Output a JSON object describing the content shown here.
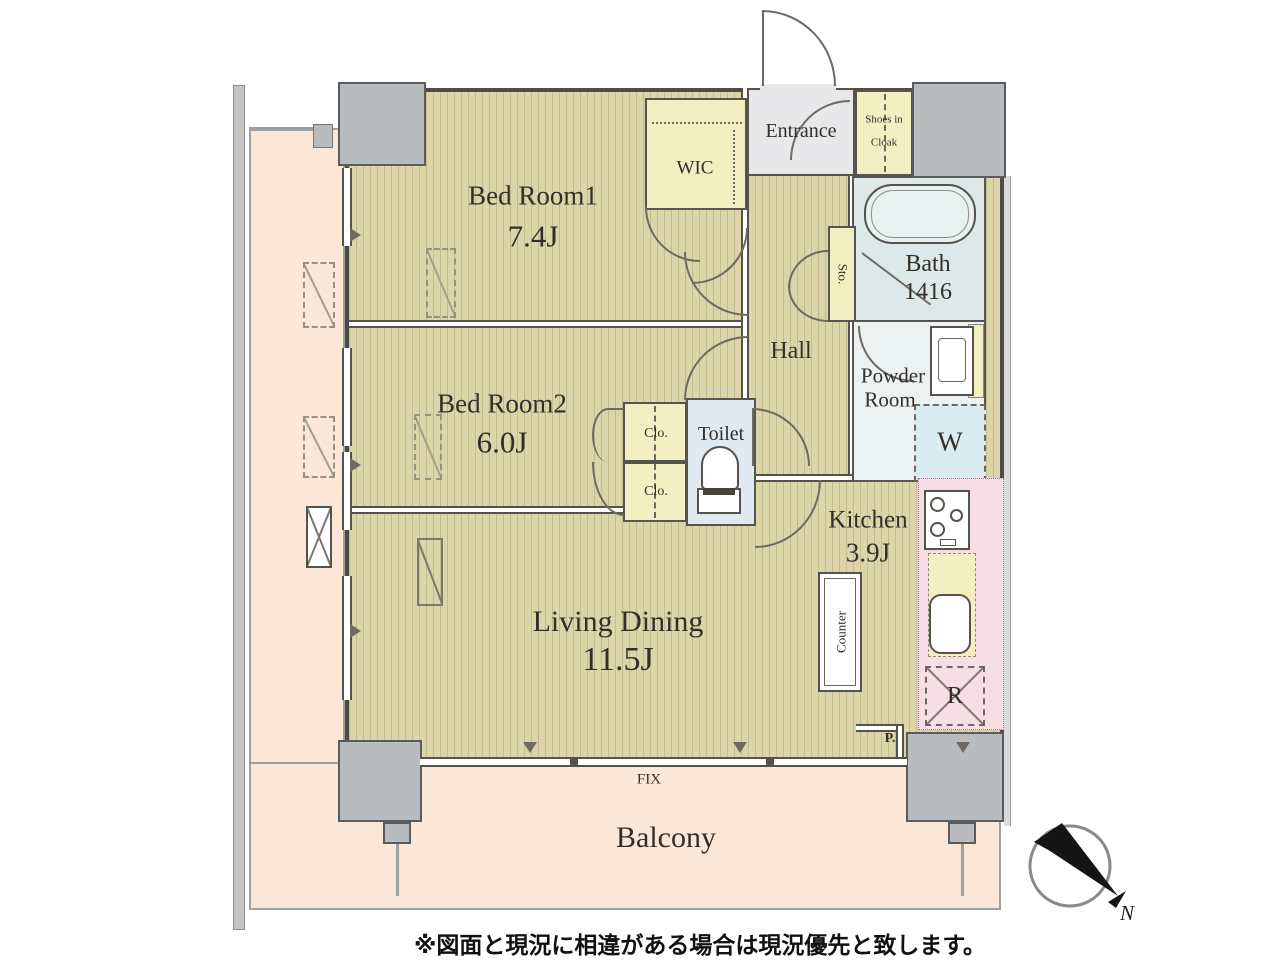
{
  "plan": {
    "rooms": {
      "bedroom1": {
        "name": "Bed Room1",
        "size": "7.4J"
      },
      "bedroom2": {
        "name": "Bed Room2",
        "size": "6.0J"
      },
      "living_dining": {
        "name": "Living Dining",
        "size": "11.5J"
      },
      "kitchen": {
        "name": "Kitchen",
        "size": "3.9J"
      },
      "bath": {
        "name": "Bath",
        "size": "1416"
      },
      "powder_room": {
        "line1": "Powder",
        "line2": "Room"
      },
      "toilet": {
        "name": "Toilet"
      },
      "hall": {
        "name": "Hall"
      },
      "entrance": {
        "name": "Entrance"
      },
      "wic": {
        "name": "WIC"
      },
      "shoes_in_cloak": {
        "line1": "Shoes in",
        "line2": "Cloak"
      },
      "balcony": {
        "name": "Balcony"
      }
    },
    "storage": {
      "sto": "Sto.",
      "clo_upper": "Clo.",
      "clo_lower": "Clo."
    },
    "appliances": {
      "washer": "W",
      "refrigerator": "R",
      "counter": "Counter"
    },
    "annotations": {
      "fix_window": "FIX",
      "pipe": "P.",
      "compass_north": "N"
    },
    "footnote": "※図面と現況に相違がある場合は現況優先と致します。"
  },
  "colors": {
    "floor_tan": "#dcd5aa",
    "balcony_pink": "#fbe7d8",
    "storage_yellow": "#f4eec3",
    "wet_area_blue": "#dde9e9",
    "kitchen_pink": "#f6dde6",
    "column_gray": "#b9bcbf",
    "wall_dark": "#55514b"
  }
}
